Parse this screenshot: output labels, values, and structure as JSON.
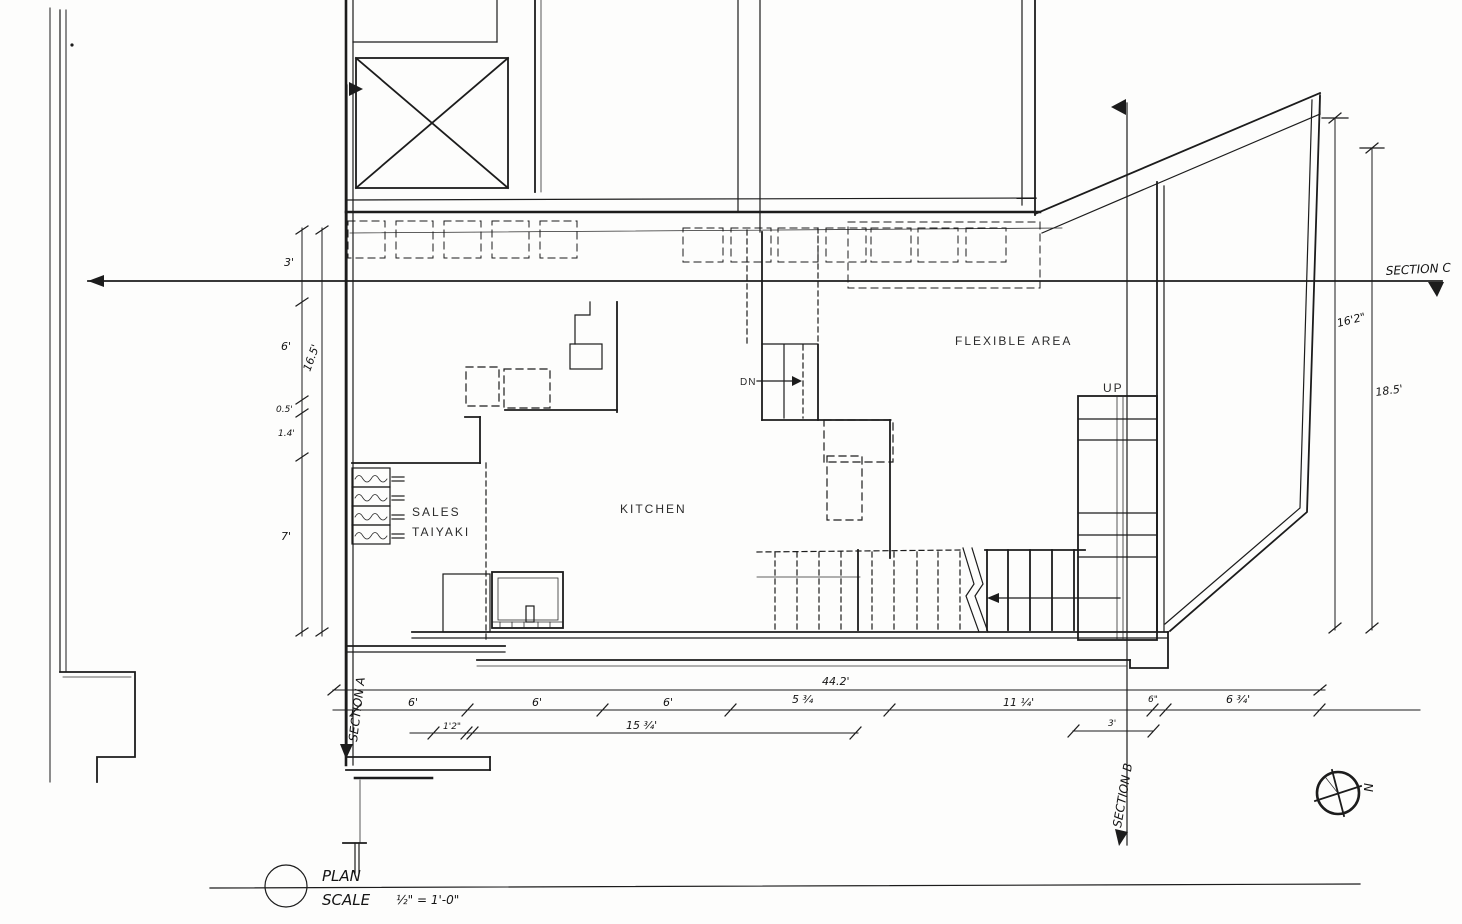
{
  "drawing": {
    "plan_label": "PLAN",
    "scale_label": "SCALE",
    "scale_value": "½\" = 1'-0\"",
    "north_label": "N"
  },
  "rooms": {
    "flexible_area": "FLEXIBLE AREA",
    "kitchen": "KITCHEN",
    "sales_line1": "SALES",
    "sales_line2": "TAIYAKI"
  },
  "stairs": {
    "up_label": "UP",
    "down_label": "DN"
  },
  "sections": {
    "a": "SECTION A",
    "b": "SECTION B",
    "c": "SECTION C"
  },
  "dimensions": {
    "left_col": {
      "d1": "3'",
      "d2": "6'",
      "d3": "16.5'",
      "d4": "0.5'",
      "d5": "1.4'",
      "d6": "7'"
    },
    "right_col": {
      "d1": "16'2\"",
      "d2": "18.5'"
    },
    "bottom_total": "44.2'",
    "bottom_row": {
      "d1": "6'",
      "d2": "6'",
      "d3": "6'",
      "d4": "5 ¾",
      "d5": "11 ¼'",
      "d6": "6\"",
      "d7": "6 ¾'"
    },
    "bottom_sub": {
      "d1": "1'2\"",
      "d2": "15 ¾'",
      "d3": "3'"
    }
  }
}
